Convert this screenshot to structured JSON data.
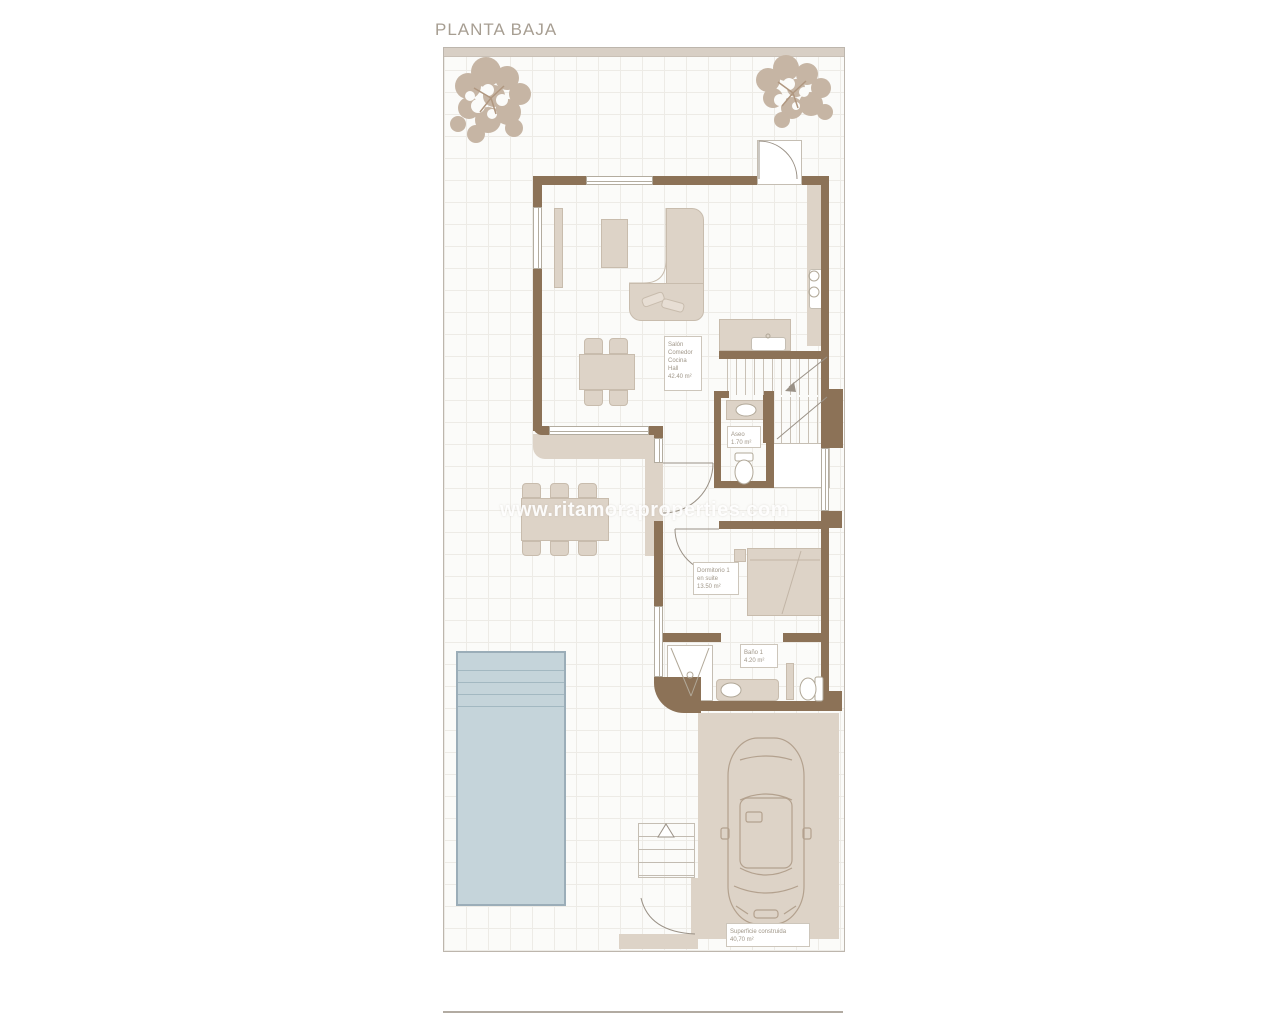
{
  "title": "PLANTA BAJA",
  "watermark": "www.ritamoraproperties.com",
  "labels": {
    "living": {
      "lines": [
        "Salón",
        "Comedor",
        "Cocina",
        "Hall",
        "42.40 m²"
      ]
    },
    "aseo": {
      "lines": [
        "Aseo",
        "1.70 m²"
      ]
    },
    "bedroom": {
      "lines": [
        "Dormitorio 1",
        "en suite",
        "13.50 m²"
      ]
    },
    "bath": {
      "lines": [
        "Baño 1",
        "4.20 m²"
      ]
    },
    "built": {
      "lines": [
        "Superficie construida",
        "40,70 m²"
      ]
    }
  },
  "colors": {
    "wall": "#8c7257",
    "floor_beige": "#ddd3c7",
    "pool_fill": "#c5d4da",
    "pool_border": "#9badb8",
    "tree": "#c6b5a4",
    "plan_line": "#b1a898",
    "label_text": "#a09789",
    "title_text": "#a79e92"
  }
}
